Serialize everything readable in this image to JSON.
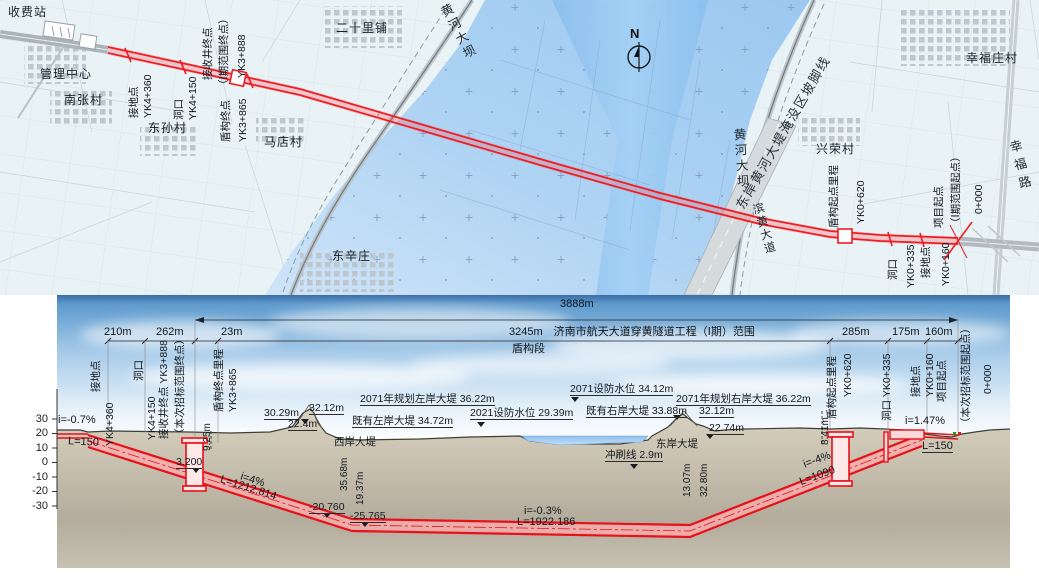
{
  "map": {
    "north": "N",
    "places": {
      "toll": "收费站",
      "mgmt": "管理中心",
      "nanzhang": "南张村",
      "dongsun": "东孙村",
      "madian": "马店村",
      "ershilipu": "二十里铺",
      "dongxinzhuang": "东辛庄",
      "xingrong": "兴荣村",
      "xingfuzhuang": "幸福庄村"
    },
    "features": {
      "west_dam": "黄河大坝",
      "east_dam": "黄河大坝",
      "binhuang": "滨黄大道",
      "xingfu_road": "幸福路",
      "west_toe": "西岸黄河大堤淹没区坡脚线",
      "east_toe": "东岸黄河大堤淹没区坡脚线"
    },
    "ck": {
      "jd_l": "接地点",
      "jd_l_v": "YK4+360",
      "dk_l": "洞口",
      "dk_l_v": "YK4+150",
      "rcv": "接收井终点",
      "rcv_scope": "（Ⅰ期范围终点）",
      "rcv_v": "YK3+888",
      "se": "盾构终点",
      "se_v": "YK3+865",
      "ss": "盾构起点里程",
      "ss_v": "YK0+620",
      "pj": "项目起点",
      "pj_scope": "（Ⅰ期范围起点）",
      "pj_v": "0+000",
      "dk_r": "洞口",
      "dk_r_v": "YK0+335",
      "jd_r": "接地点",
      "jd_r_v": "YK0+160"
    }
  },
  "profile": {
    "dims": {
      "total": "3888m",
      "s210": "210m",
      "s262": "262m",
      "s23": "23m",
      "range": "3245m　济南市航天大道穿黄隧道工程（Ⅰ期）范围",
      "shield": "盾构段",
      "s285": "285m",
      "s175": "175m",
      "s160": "160m",
      "d925": "9.25m",
      "d841": "8.41m"
    },
    "st": {
      "jd_l": "接地点",
      "jd_l_v": "YK4+360",
      "dk_l": "洞口",
      "dk_l_v": "YK4+150",
      "rcv": "接收井终点 YK3+888",
      "rcv_scope": "（本次招标范围终点）",
      "se": "盾构终点里程",
      "se_v": "YK3+865",
      "ss": "盾构起点里程",
      "ss_v": "YK0+620",
      "dk_r": "洞口 YK0+335",
      "jd_r": "接地点",
      "jd_r_v": "YK0+160",
      "pj": "项目起点",
      "pj_scope": "（本次招标范围起点）",
      "pj_v": "0+000"
    },
    "elev": [
      "30",
      "20",
      "10",
      "0",
      "-10",
      "-20",
      "-30"
    ],
    "ann": {
      "l30": "30.29m",
      "l32": "32.12m",
      "l22": "22.4m",
      "plan_left": "2071年规划左岸大堤 36.22m",
      "exist_left": "既有左岸大堤 34.72m",
      "flood2021": "2021设防水位 29.39m",
      "flood2071": "2071设防水位 34.12m",
      "exist_right": "既有右岸大堤 33.88m",
      "plan_right": "2071年规划右岸大堤 36.22m",
      "r32": "32.12m",
      "r22": "22.74m",
      "west_dike": "西岸大堤",
      "west_h": "35.68m",
      "west_d": "19.37m",
      "east_dike": "东岸大堤",
      "east_h": "32.80m",
      "east_d": "13.07m",
      "scour": "冲刷线 2.9m",
      "g0": "i=-0.7%",
      "g0l": "L=150",
      "lvl": "3.200",
      "g1": "i=4%",
      "g1l": "L=1212.814",
      "low1": "-20.760",
      "low2": "-25.765",
      "g2": "i=-0.3%",
      "g2l": "L=1922.186",
      "g3": "i=-4%",
      "g3l": "L=1090",
      "g4": "i=1.47%",
      "g4l": "L=150"
    },
    "colors": {
      "tunnel_red": "#e8101a",
      "river_blue": "#9fcdf4",
      "ground_tan": "#cfc8b6"
    }
  }
}
